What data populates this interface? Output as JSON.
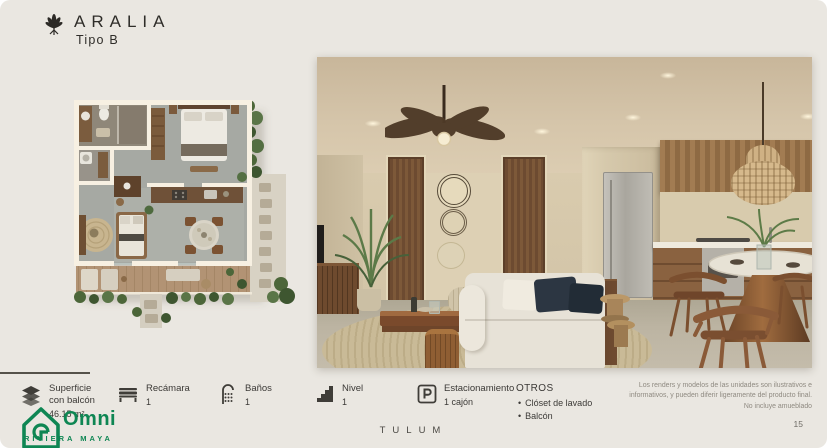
{
  "header": {
    "title": "ARALIA",
    "subtitle": "Tipo B",
    "logo_icon": "agave-plant-icon"
  },
  "specs": [
    {
      "icon": "surface-layers-icon",
      "label": "Superficie\ncon balcón",
      "value": "46.15 m²"
    },
    {
      "icon": "bed-icon",
      "label": "Recámara",
      "value": "1"
    },
    {
      "icon": "shower-icon",
      "label": "Baños",
      "value": "1"
    },
    {
      "icon": "stairs-icon",
      "label": "Nivel",
      "value": "1"
    },
    {
      "icon": "parking-icon",
      "label": "Estacionamiento",
      "value": "1 cajón"
    }
  ],
  "otros": {
    "title": "OTROS",
    "items": [
      "Clóset de lavado",
      "Balcón"
    ]
  },
  "footer": {
    "location": "TULUM",
    "page_number": "15",
    "disclaimer": [
      "Los renders y modelos de las unidades son ilustrativos e",
      "informativos, y pueden diferir ligeramente del producto final.",
      "No incluye amueblado"
    ]
  },
  "watermark": {
    "name": "Omni",
    "tagline": "RIVIERA MAYA",
    "icon": "house-logo-icon",
    "color": "#0e8653"
  },
  "colors": {
    "slide_background": "#eae7e1",
    "text_dark": "#2f2d29",
    "accent_green": "#0e8653"
  }
}
